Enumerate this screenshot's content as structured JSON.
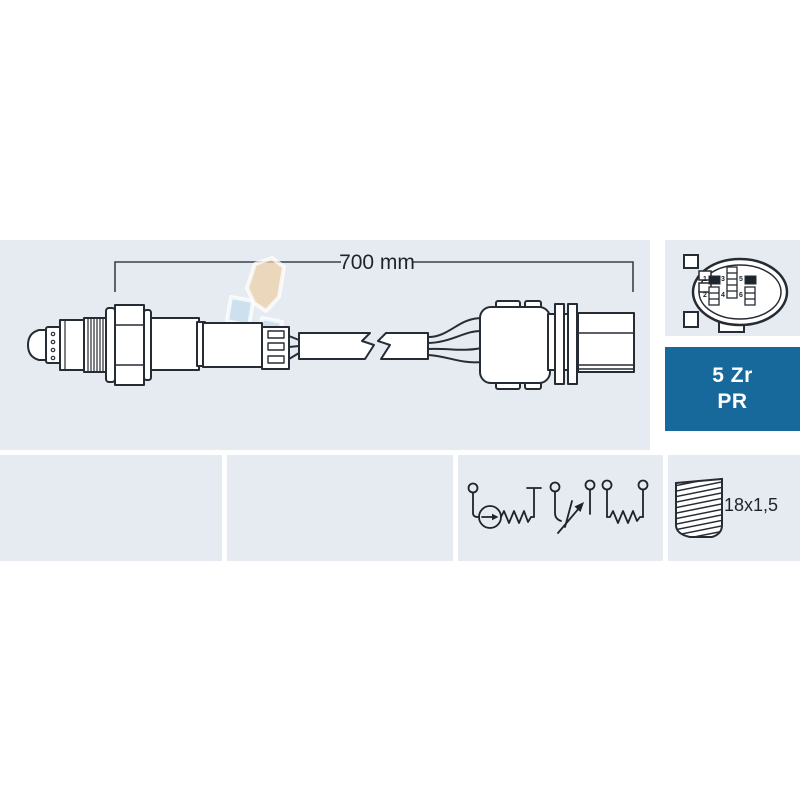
{
  "dimension": {
    "label": "700 mm"
  },
  "badge": {
    "line1": "5 Zr",
    "line2": "PR"
  },
  "thread": {
    "label": "18x1,5"
  },
  "connector": {
    "pin_labels": [
      "1",
      "3",
      "5",
      "2",
      "4",
      "6"
    ]
  },
  "watermark": {
    "text": "FAE"
  },
  "colors": {
    "panel_bg": "#e6ebf2",
    "badge_bg": "#17699c",
    "badge_text": "#ffffff",
    "line": "#262c33",
    "watermark_tan": "#ecd0a8",
    "watermark_blue": "#c3dceb"
  }
}
